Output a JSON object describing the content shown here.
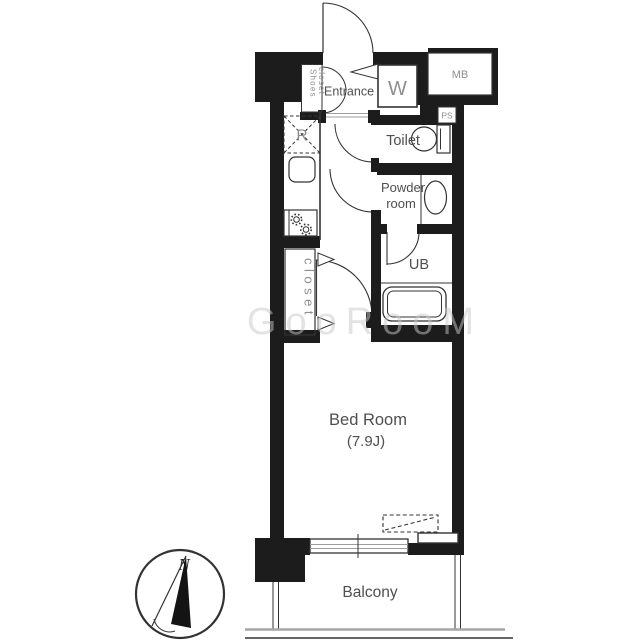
{
  "floorplan": {
    "rooms": {
      "entrance": "Entrance",
      "toilet": "Toilet",
      "powder_room_line1": "Powder",
      "powder_room_line2": "room",
      "unit_bath": "UB",
      "closet": "closet",
      "bedroom_line1": "Bed Room",
      "bedroom_line2": "(7.9J)",
      "balcony": "Balcony"
    },
    "fixtures": {
      "washing_machine": "W",
      "meter_box": "MB",
      "pipe_space": "PS",
      "refrigerator": "R",
      "shoes_closet_line1": "Shoes",
      "shoes_closet_line2": "closet"
    },
    "compass": {
      "north": "N"
    },
    "watermark": "GooRooM",
    "colors": {
      "wall": "#1c1c1c",
      "line": "#333333",
      "room_label": "#4f4f4f",
      "utility_label": "#8e8e8e",
      "window_line": "#9e9e9e",
      "ground_line": "#a6a6a6",
      "watermark": "#c8c8c8"
    }
  }
}
